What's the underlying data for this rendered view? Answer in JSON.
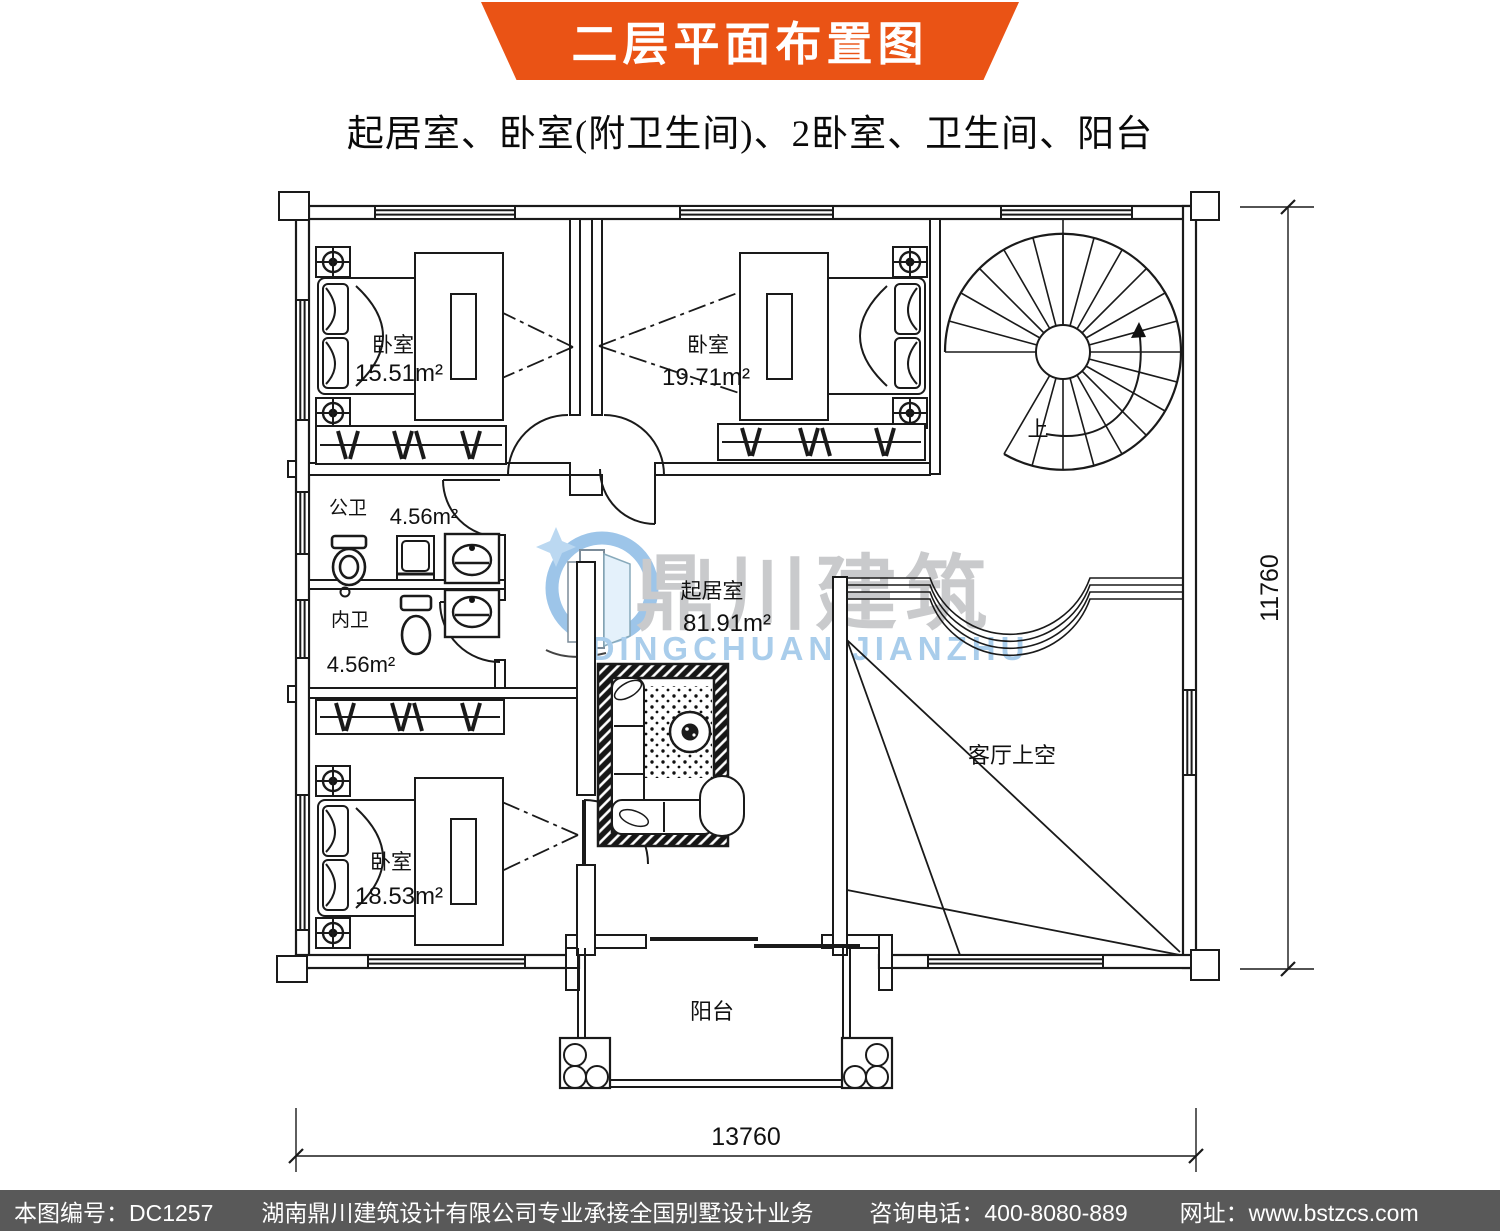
{
  "header": {
    "title": "二层平面布置图",
    "subtitle": "起居室、卧室(附卫生间)、2卧室、卫生间、阳台"
  },
  "plan": {
    "rooms": [
      {
        "id": "bedroom-top-left",
        "name": "卧室",
        "area": "15.51m²"
      },
      {
        "id": "bedroom-top-mid",
        "name": "卧室",
        "area": "19.71m²"
      },
      {
        "id": "bath-public",
        "name": "公卫",
        "area": "4.56m²"
      },
      {
        "id": "bath-private",
        "name": "内卫",
        "area": "4.56m²"
      },
      {
        "id": "bedroom-bottom",
        "name": "卧室",
        "area": "18.53m²"
      },
      {
        "id": "living-room",
        "name": "起居室",
        "area": "81.91m²"
      },
      {
        "id": "void-over-parlor",
        "name": "客厅上空"
      },
      {
        "id": "balcony",
        "name": "阳台"
      },
      {
        "id": "stairs-up",
        "name": "上"
      }
    ],
    "dimensions": {
      "right": "11760",
      "bottom": "13760"
    }
  },
  "watermark": {
    "cn": "鼎川建筑",
    "en": "DINGCHUAN JIANZHU"
  },
  "footer": {
    "drawing_no": "本图编号：DC1257",
    "company": "湖南鼎川建筑设计有限公司专业承接全国别墅设计业务",
    "phone": "咨询电话：400-8080-889",
    "website": "网址：www.bstzcs.com"
  },
  "colors": {
    "accent_orange": "#EA5315",
    "footer_bg": "#595959",
    "line": "#1a1a1a",
    "watermark_gray": "#C9CACC",
    "watermark_blue": "#A9CDEB",
    "logo_blue": "#9DC5E9"
  }
}
